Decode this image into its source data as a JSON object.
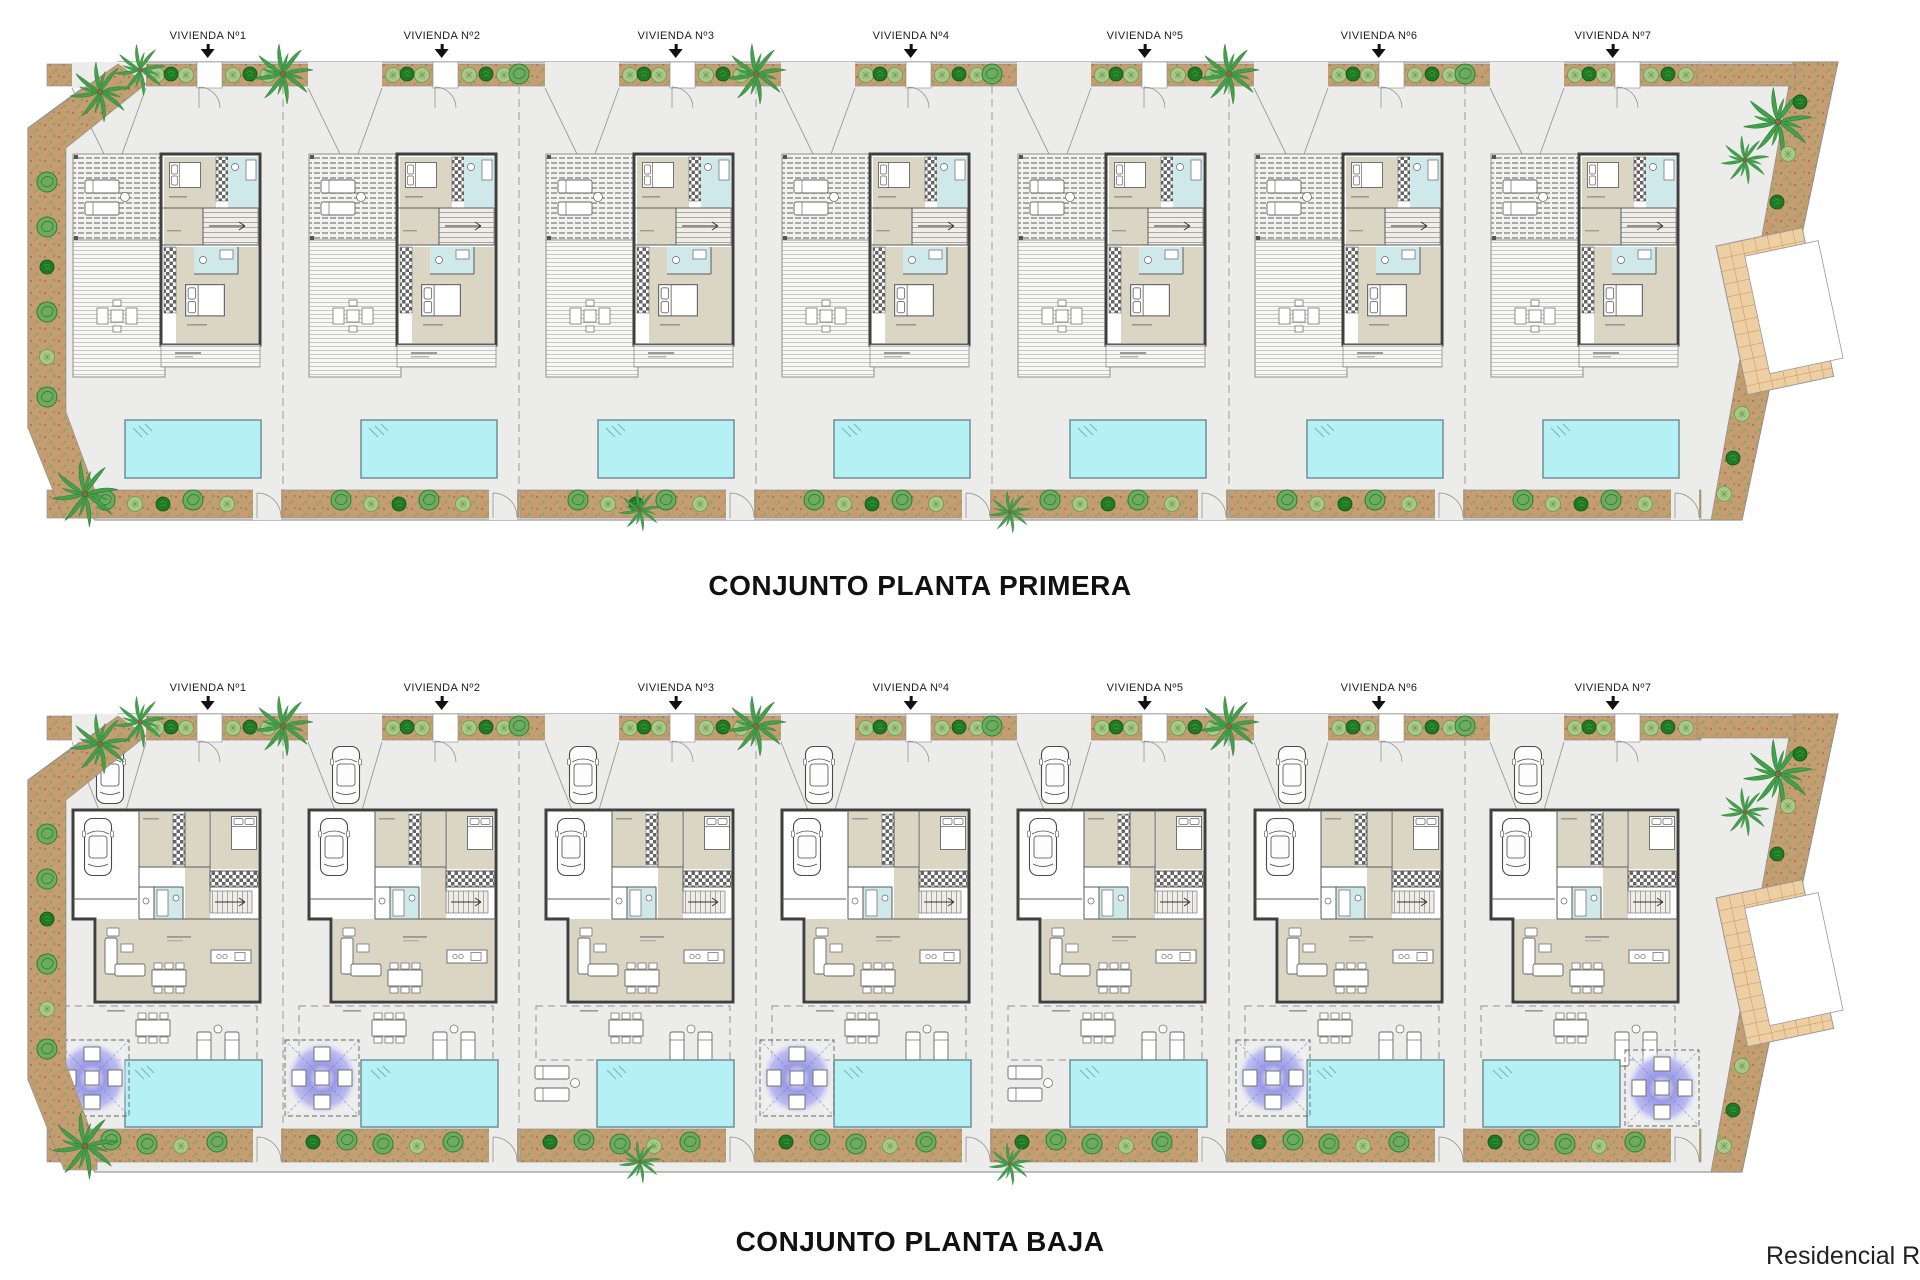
{
  "page": {
    "watermark": "Residencial R",
    "background": "#ffffff"
  },
  "sections": [
    {
      "id": "planta-primera",
      "title": "CONJUNTO PLANTA PRIMERA",
      "units": [
        {
          "label": "VIVIENDA Nº1",
          "amenities": [
            "deck",
            "pergola-slats",
            "loungers",
            "pool"
          ]
        },
        {
          "label": "VIVIENDA Nº2",
          "amenities": [
            "deck",
            "pergola-slats",
            "loungers",
            "pool"
          ]
        },
        {
          "label": "VIVIENDA Nº3",
          "amenities": [
            "deck",
            "pergola-slats",
            "loungers",
            "pool"
          ]
        },
        {
          "label": "VIVIENDA Nº4",
          "amenities": [
            "deck",
            "pergola-slats",
            "loungers",
            "pool"
          ]
        },
        {
          "label": "VIVIENDA Nº5",
          "amenities": [
            "deck",
            "pergola-slats",
            "loungers",
            "pool"
          ]
        },
        {
          "label": "VIVIENDA Nº6",
          "amenities": [
            "deck",
            "pergola-slats",
            "loungers",
            "pool"
          ]
        },
        {
          "label": "VIVIENDA Nº7",
          "amenities": [
            "deck",
            "pergola-slats",
            "loungers",
            "pool"
          ]
        }
      ]
    },
    {
      "id": "planta-baja",
      "title": "CONJUNTO PLANTA BAJA",
      "units": [
        {
          "label": "VIVIENDA Nº1",
          "amenities": [
            "driveway-car",
            "garage-car",
            "terrace",
            "pergola-left",
            "pool"
          ]
        },
        {
          "label": "VIVIENDA Nº2",
          "amenities": [
            "driveway-car",
            "garage-car",
            "terrace",
            "pergola-left",
            "pool"
          ]
        },
        {
          "label": "VIVIENDA Nº3",
          "amenities": [
            "driveway-car",
            "garage-car",
            "terrace",
            "loungers",
            "pool"
          ]
        },
        {
          "label": "VIVIENDA Nº4",
          "amenities": [
            "driveway-car",
            "garage-car",
            "terrace",
            "pergola-left",
            "pool"
          ]
        },
        {
          "label": "VIVIENDA Nº5",
          "amenities": [
            "driveway-car",
            "garage-car",
            "terrace",
            "loungers",
            "pool"
          ]
        },
        {
          "label": "VIVIENDA Nº6",
          "amenities": [
            "driveway-car",
            "garage-car",
            "terrace",
            "pergola-left",
            "pool"
          ]
        },
        {
          "label": "VIVIENDA Nº7",
          "amenities": [
            "driveway-car",
            "garage-car",
            "terrace",
            "pergola-right",
            "pool"
          ]
        }
      ]
    }
  ],
  "colors": {
    "plot": "#ececeb",
    "wall": "#3f3f3f",
    "room": "#dbd5c4",
    "bath": "#cfe9ea",
    "pool": "#b5f0f4",
    "pool_edge": "#6e9094",
    "garden_soil": "#c49d72",
    "leaf": "#4ba04b",
    "pergola": "#9a9ae6",
    "tile": "#eecea3",
    "title_text": "#111111",
    "label_text": "#1c1c1c"
  }
}
